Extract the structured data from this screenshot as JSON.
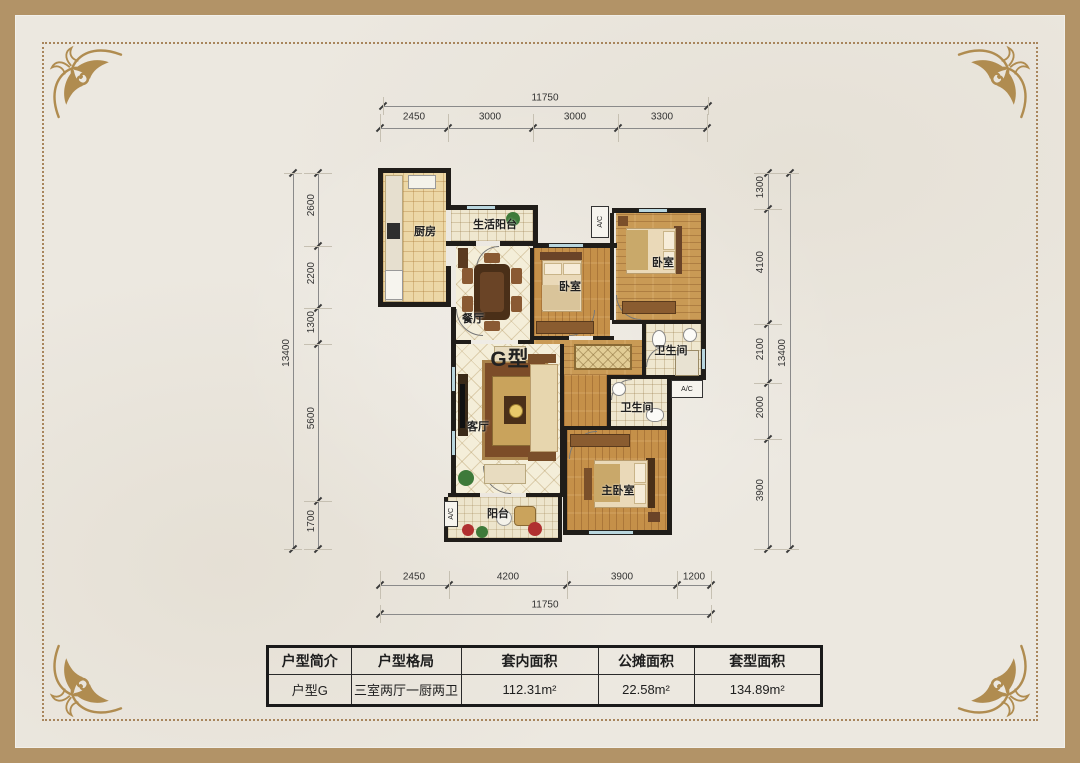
{
  "frame": {
    "band_color": "#b29367",
    "dotted_color": "#a8855c",
    "paper_color": "#ece8e0",
    "ornament_color": "#b08c50"
  },
  "plan": {
    "unit_label": "G型",
    "ac_label": "A/C",
    "rooms": {
      "kitchen": "厨房",
      "life_balcony": "生活阳台",
      "dining": "餐厅",
      "bedroom_mid": "卧室",
      "bedroom_right": "卧室",
      "bath_top": "卫生间",
      "living": "客厅",
      "bath_lower": "卫生间",
      "master": "主卧室",
      "balcony": "阳台"
    },
    "dimensions": {
      "top": {
        "total": "11750",
        "segments": [
          "2450",
          "3000",
          "3000",
          "3300"
        ]
      },
      "bottom": {
        "total": "11750",
        "segments": [
          "2450",
          "4200",
          "3900",
          "1200"
        ]
      },
      "left": {
        "total": "13400",
        "segments": [
          "2600",
          "2200",
          "1300",
          "5600",
          "1700"
        ]
      },
      "right": {
        "total": "13400",
        "segments": [
          "1300",
          "4100",
          "2100",
          "2000",
          "3900"
        ]
      }
    }
  },
  "table": {
    "headers": [
      "户型简介",
      "户型格局",
      "套内面积",
      "公摊面积",
      "套型面积"
    ],
    "row": [
      "户型G",
      "三室两厅一厨两卫",
      "112.31m²",
      "22.58m²",
      "134.89m²"
    ]
  }
}
